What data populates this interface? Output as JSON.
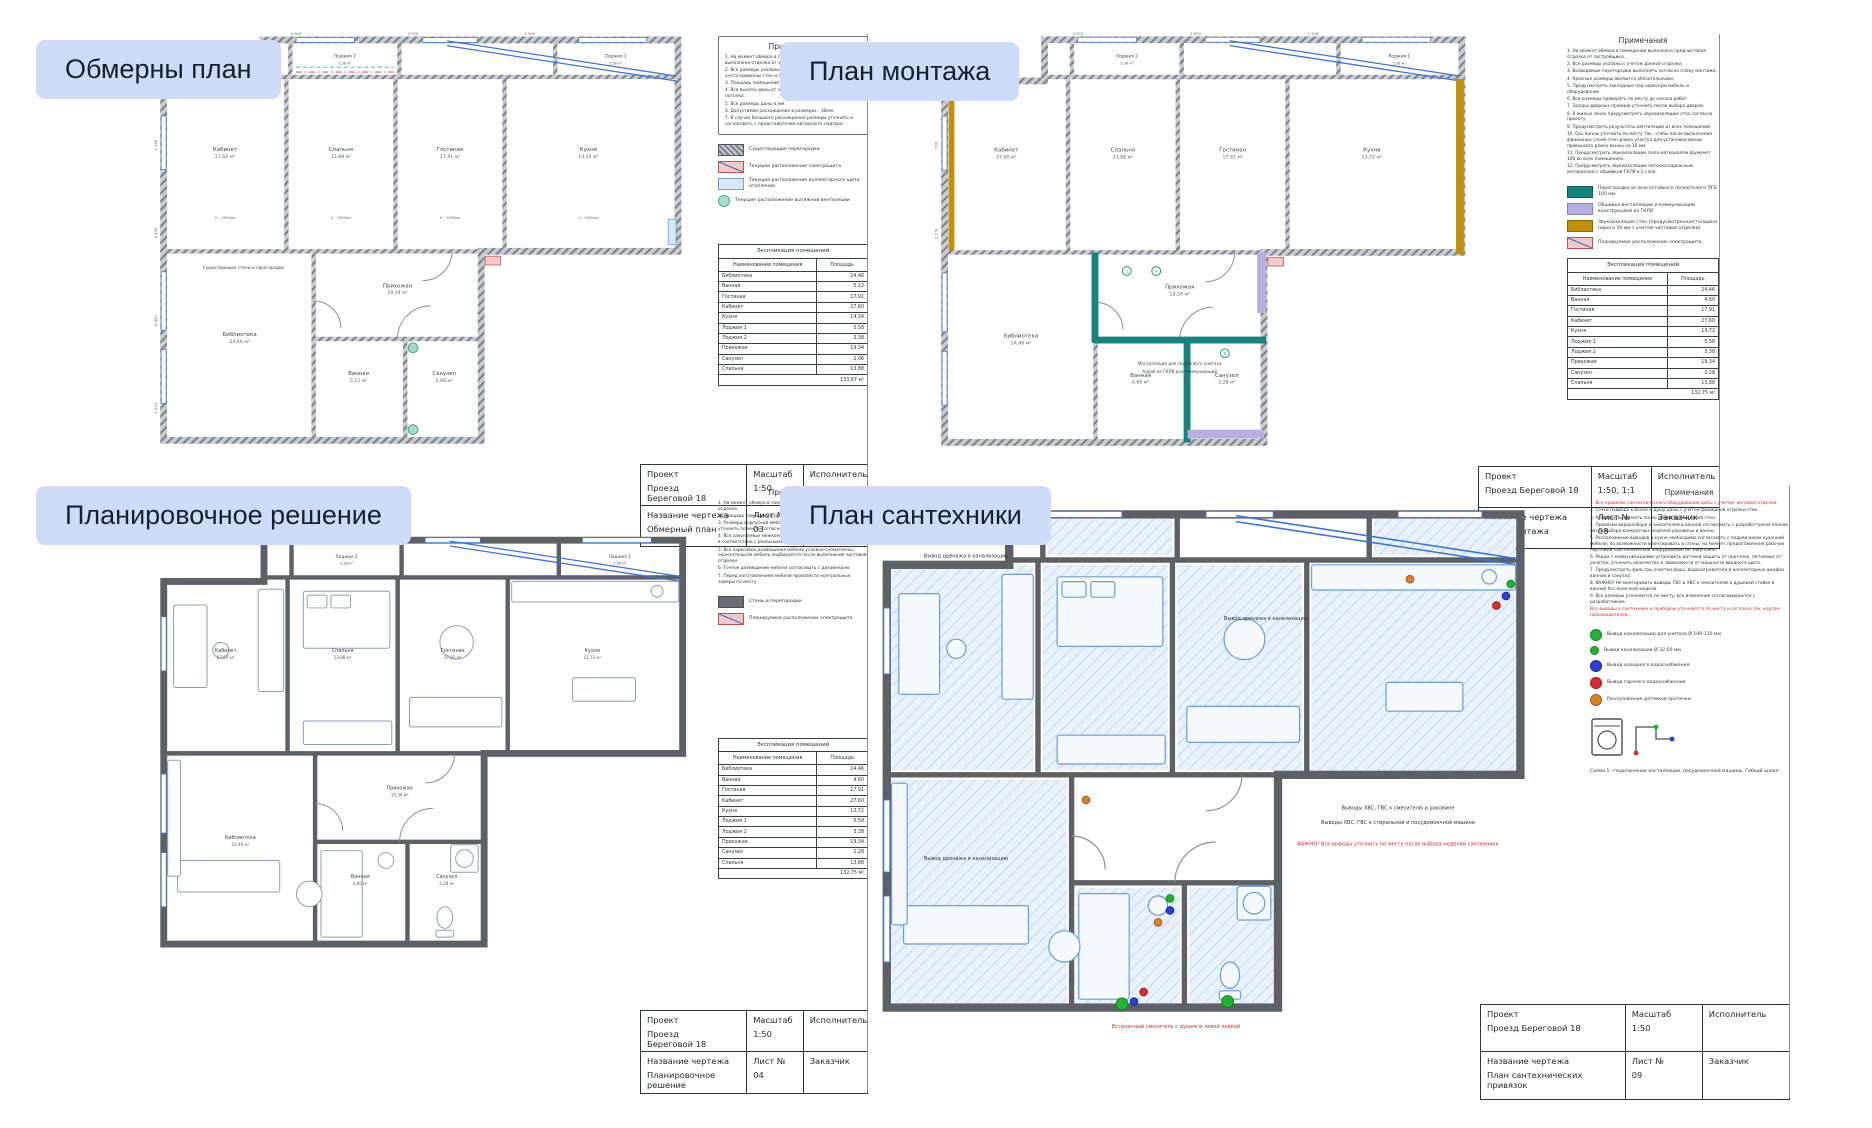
{
  "page": {
    "background": "#ffffff",
    "label_chip_color": "#cedbf7"
  },
  "sheets": [
    {
      "overlay_label": "Обмерны план",
      "notes": {
        "title": "Примечания",
        "boxed": true,
        "lines": [
          {
            "text": "1. На момент обмера в помещении предчистовая выполнена отделка от застройщика."
          },
          {
            "text": "2. Все размеры указаны с учетом данной отделки, без учета кривизны стен и перекрытий."
          },
          {
            "text": "3. Площадь помещений указаны без учета перегородок."
          },
          {
            "text": "4. Все высоты даны от чистового пола до существующего потолка."
          },
          {
            "text": "5. Все размеры даны в мм."
          },
          {
            "text": "6. Допустимое расхождение в размерах - 30мм."
          },
          {
            "text": "7. В случае большого расхождения размеры уточнить и согласовать с представителем авторского надзора."
          }
        ]
      },
      "legend": [
        {
          "kind": "hatch",
          "color": "#b9bdc4",
          "label": "Существующие перегородки"
        },
        {
          "kind": "ehatch",
          "color": "#f0caca",
          "border": "#c0504d",
          "label": "Текущее расположение электрощита"
        },
        {
          "kind": "solid",
          "color": "#d9e9fb",
          "border": "#6f9fd8",
          "label": "Текущее расположение коллекторного щита отопления"
        },
        {
          "kind": "circle",
          "color": "#a7ddd0",
          "border": "#55a391",
          "label": "Текущее расположение вытяжной вентиляции"
        }
      ],
      "table": {
        "title": "Экспликация помещений",
        "col1": "Наименование помещения",
        "col2": "Площадь",
        "rows": [
          [
            "Библиотека",
            "24,46"
          ],
          [
            "Ванная",
            "5,12"
          ],
          [
            "Гостиная",
            "17,91"
          ],
          [
            "Кабинет",
            "27,60"
          ],
          [
            "Кухня",
            "14,34"
          ],
          [
            "Лоджия 1",
            "5,58"
          ],
          [
            "Лоджия 2",
            "3,38"
          ],
          [
            "Прихожая",
            "19,34"
          ],
          [
            "Санузел",
            "2,06"
          ],
          [
            "Спальня",
            "13,88"
          ]
        ],
        "total": "133,67 м²"
      },
      "title_block": {
        "project_label": "Проект",
        "project": "Проезд\nБереговой 18",
        "scale_label": "Масштаб",
        "scale": "1:50",
        "executor_label": "Исполнитель",
        "drawing_label": "Название чертежа",
        "drawing": "Обмерный план",
        "sheet_label": "Лист №",
        "sheet": "03",
        "client_label": "Заказчик"
      },
      "plan": {
        "style": "measure",
        "rooms": [
          {
            "id": "kabinet",
            "name": "Кабинет",
            "area": "27,60 м²"
          },
          {
            "id": "spalnya",
            "name": "Спальня",
            "area": "13,88 м²"
          },
          {
            "id": "gostinaya",
            "name": "Гостиная",
            "area": "17,91 м²"
          },
          {
            "id": "kuhnya",
            "name": "Кухня",
            "area": "14,34 м²"
          },
          {
            "id": "lodzhiya2",
            "name": "Лоджия 2",
            "area": "3,38 м²"
          },
          {
            "id": "lodzhiya1",
            "name": "Лоджия 1",
            "area": "5,58 м²"
          },
          {
            "id": "prihozhaya",
            "name": "Прихожая",
            "area": "19,34 м²"
          },
          {
            "id": "biblioteka",
            "name": "Библиотека",
            "area": "24,46 м²"
          },
          {
            "id": "vannaya",
            "name": "Ванная",
            "area": "5,12 м²"
          },
          {
            "id": "sanuzel",
            "name": "Санузел",
            "area": "2,06 м²"
          }
        ],
        "dims": [
          "5 915",
          "2 970",
          "1 950",
          "1 226",
          "2 435",
          "6 450",
          "1 510"
        ],
        "height_note": "H - 2985мм",
        "annotations": [
          {
            "text": "Существующие стены и перегородки",
            "x": 96,
            "y": 247,
            "color": "#3a3f46"
          }
        ]
      }
    },
    {
      "overlay_label": "План монтажа",
      "notes": {
        "title": "Примечания",
        "boxed": false,
        "lines": [
          {
            "text": "1. На момент обмера в помещении выполнена предчистовая отделка от застройщика."
          },
          {
            "text": "2. Все размеры указаны с учетом данной отделки."
          },
          {
            "text": "3. Возводимые перегородки выполнять согласно плану монтажа."
          },
          {
            "text": "4. Красные размеры являются обязательными."
          },
          {
            "text": "5. Предусмотреть закладные под навесную мебель и оборудование."
          },
          {
            "text": "6. Все размеры проверять по месту до начала работ."
          },
          {
            "text": "7. Зазоры дверных проемов уточнить после выбора дверей."
          },
          {
            "text": "8. В жилых зонах предусмотреть звукоизоляцию стен согласно проекту."
          },
          {
            "text": "9. Предусмотреть результаты вентиляции из всех помещений."
          },
          {
            "text": "10. Ось ванны уточнить по месту так, чтобы после выполнения финишных слоев стен длина участка для установки ванны превышала длину ванны на 10 мм."
          },
          {
            "text": "11. Предусмотреть звукоизоляцию пола материалом Шуманет 100 во всех помещениях."
          },
          {
            "text": "12. Предусмотреть звукоизоляцию потолка каркасным материалом с обшивкой ГКЛВ в 2 слоя."
          }
        ]
      },
      "legend": [
        {
          "kind": "solid",
          "color": "#16837d",
          "border": "#0e5f5b",
          "label": "Перегородка из влагостойкого полнотелого ПГБ 100 мм"
        },
        {
          "kind": "solid",
          "color": "#b9aee4",
          "border": "#8b7fc4",
          "label": "Обшивка инсталляции и коммуникаций конструкцией из ГКЛВ"
        },
        {
          "kind": "solid",
          "color": "#c1900b",
          "border": "#8f6a06",
          "label": "Звукоизоляция стен (предусмотренная толщина пирога 50 мм с учетом чистовой отделки)"
        },
        {
          "kind": "ehatch",
          "color": "#f0caca",
          "border": "#c0504d",
          "label": "Планируемое расположение электрощита"
        }
      ],
      "table": {
        "title": "Экспликация помещений",
        "col1": "Наименование помещения",
        "col2": "Площадь",
        "rows": [
          [
            "Библиотека",
            "24,46"
          ],
          [
            "Ванная",
            "4,60"
          ],
          [
            "Гостиная",
            "17,91"
          ],
          [
            "Кабинет",
            "27,60"
          ],
          [
            "Кухня",
            "13,72"
          ],
          [
            "Лоджия 1",
            "5,58"
          ],
          [
            "Лоджия 2",
            "3,38"
          ],
          [
            "Прихожая",
            "19,34"
          ],
          [
            "Санузел",
            "2,28"
          ],
          [
            "Спальня",
            "13,88"
          ]
        ],
        "total": "132,75 м²"
      },
      "title_block": {
        "project_label": "Проект",
        "project": "Проезд Береговой 18",
        "scale_label": "Масштаб",
        "scale": "1:50, 1:1",
        "executor_label": "Исполнитель",
        "drawing_label": "Название чертежа",
        "drawing": "План монтажа",
        "sheet_label": "Лист №",
        "sheet": "08",
        "client_label": "Заказчик"
      },
      "plan": {
        "style": "montage",
        "rooms": [
          {
            "id": "kabinet",
            "name": "Кабинет",
            "area": "27,60 м²"
          },
          {
            "id": "spalnya",
            "name": "Спальня",
            "area": "13,88 м²"
          },
          {
            "id": "gostinaya",
            "name": "Гостиная",
            "area": "17,91 м²"
          },
          {
            "id": "kuhnya",
            "name": "Кухня",
            "area": "13,72 м²"
          },
          {
            "id": "lodzhiya2",
            "name": "Лоджия 2",
            "area": "3,38 м²"
          },
          {
            "id": "lodzhiya1",
            "name": "Лоджия 1",
            "area": "5,58 м²"
          },
          {
            "id": "prihozhaya",
            "name": "Прихожая",
            "area": "19,34 м²"
          },
          {
            "id": "biblioteka",
            "name": "Библиотека",
            "area": "24,46 м²"
          },
          {
            "id": "vannaya",
            "name": "Ванная",
            "area": "4,60 м²"
          },
          {
            "id": "sanuzel",
            "name": "Санузел",
            "area": "2,28 м²"
          }
        ],
        "dims": [
          "3 370",
          "2 970",
          "1 226",
          "700",
          "2 170"
        ],
        "annotations": [
          {
            "text": "Инсталляция для подвесного унитаза",
            "x": 254,
            "y": 344,
            "color": "#3a3f46"
          },
          {
            "text": "Короб из ГКЛВ для коммуникаций",
            "x": 254,
            "y": 352,
            "color": "#3a3f46"
          }
        ]
      }
    },
    {
      "overlay_label": "Планировочное решение",
      "notes": {
        "title": "Примечания",
        "boxed": false,
        "lines": [
          {
            "text": "1. На момент обмера в помещении выполнена предчистовая отделка."
          },
          {
            "text": "2. Площадь помещений указана без учета чистовой отделки."
          },
          {
            "text": "3. Размеры корпусной мебели и сантехнического оборудования уточнить по месту согласно спецификациям изделий."
          },
          {
            "text": "4. Все закупаемые межкомнатные конструкции корректировать в соответствии с реальными размерами после замеров."
          },
          {
            "text": "5. Все зарисовки размещения мебели условно-схематичны; окончательная мебель подбирается после выполнения чистовой отделки."
          },
          {
            "text": "6. Точное размещение мебели согласовать с дизайнером."
          },
          {
            "text": "7. Перед изготовлением мебели произвести контрольные замеры по месту."
          }
        ]
      },
      "legend": [
        {
          "kind": "solid",
          "color": "#6a6f76",
          "border": "#4a4e54",
          "label": "Стены и перегородки"
        },
        {
          "kind": "ehatch",
          "color": "#f0caca",
          "border": "#c0504d",
          "label": "Планируемое расположение электрощита"
        }
      ],
      "table": {
        "title": "Экспликация помещений",
        "col1": "Наименование помещения",
        "col2": "Площадь",
        "rows": [
          [
            "Библиотека",
            "24,46"
          ],
          [
            "Ванная",
            "4,60"
          ],
          [
            "Гостиная",
            "17,91"
          ],
          [
            "Кабинет",
            "27,60"
          ],
          [
            "Кухня",
            "13,72"
          ],
          [
            "Лоджия 1",
            "5,58"
          ],
          [
            "Лоджия 2",
            "3,38"
          ],
          [
            "Прихожая",
            "19,34"
          ],
          [
            "Санузел",
            "2,28"
          ],
          [
            "Спальня",
            "13,88"
          ]
        ],
        "total": "132,75 м²"
      },
      "title_block": {
        "project_label": "Проект",
        "project": "Проезд\nБереговой 18",
        "scale_label": "Масштаб",
        "scale": "1:50",
        "executor_label": "Исполнитель",
        "drawing_label": "Название чертежа",
        "drawing": "Планировочное\nрешение",
        "sheet_label": "Лист №",
        "sheet": "04",
        "client_label": "Заказчик"
      },
      "plan": {
        "style": "plan",
        "rooms": [
          {
            "id": "kabinet",
            "name": "Кабинет",
            "area": "27,60 м²"
          },
          {
            "id": "spalnya",
            "name": "Спальня",
            "area": "13,88 м²"
          },
          {
            "id": "gostinaya",
            "name": "Гостиная",
            "area": "17,91 м²"
          },
          {
            "id": "kuhnya",
            "name": "Кухня",
            "area": "13,72 м²"
          },
          {
            "id": "lodzhiya2",
            "name": "Лоджия 2",
            "area": "3,38 м²"
          },
          {
            "id": "lodzhiya1",
            "name": "Лоджия 1",
            "area": "5,58 м²"
          },
          {
            "id": "prihozhaya",
            "name": "Прихожая",
            "area": "19,34 м²"
          },
          {
            "id": "biblioteka",
            "name": "Библиотека",
            "area": "24,46 м²"
          },
          {
            "id": "vannaya",
            "name": "Ванная",
            "area": "4,60 м²"
          },
          {
            "id": "sanuzel",
            "name": "Санузел",
            "area": "2,28 м²"
          }
        ],
        "dims": [],
        "annotations": []
      }
    },
    {
      "overlay_label": "План сантехники",
      "notes": {
        "title": "Примечания",
        "boxed": false,
        "lines": [
          {
            "text": "1. Все привязки сантехнического оборудования даны с учетом чистовой отделки.",
            "color": "#d42a2a"
          },
          {
            "text": "2. Точки подвода к ванне и душу даны с учетом финишной отделки стен."
          },
          {
            "text": "3. Разводку выполнять после штукатурных слоев стен."
          },
          {
            "text": "4. Привязки водоразбора к смесителям в ванной согласовать с разработчиком планов после выбора конкретных моделей раковины и ванны."
          },
          {
            "text": "5. Расположение выводов в кухне необходимо согласовать с подрядчиком кухонной мебели; по возможности вмонтировать в стены; на момент предоставления рабочих чертежей сантехническое оборудование не закуплено."
          },
          {
            "text": "6. Рядом с коммуникациями установить датчики защиты от протечек, питаемые от розетки; уточнить количество в зависимости от мощности вводного щита."
          },
          {
            "text": "7. Предусмотреть фильтры очистки воды, водонагреватели в коллекторных шкафах ванной и санузла."
          },
          {
            "text": "8. ВАЖНО! Не монтировать выводы ГВС и ХВС к смесителям и душевой стойке в ванной без конечной модели."
          },
          {
            "text": "9. Все размеры уточняются по месту; все изменения согласовываются с разработчиком."
          },
          {
            "text": "Все выводы к сантехнике и приборам уточняются по месту и согласно тех. картам производителей.",
            "color": "#d42a2a"
          }
        ]
      },
      "legend": [
        {
          "kind": "circle",
          "color": "#24b232",
          "border": "#178223",
          "label": "Вывод канализации для унитаза Ø 100-110 мм"
        },
        {
          "kind": "circle",
          "color": "#24b232",
          "border": "#178223",
          "small": true,
          "label": "Вывод канализации Ø 32-50 мм"
        },
        {
          "kind": "circle",
          "color": "#2b3fd8",
          "border": "#1d2b9b",
          "label": "Вывод холодного водоснабжения"
        },
        {
          "kind": "circle",
          "color": "#d92b2b",
          "border": "#9e1d1d",
          "label": "Вывод горячего водоснабжения"
        },
        {
          "kind": "circle",
          "color": "#d9822b",
          "border": "#9e5c1d",
          "label": "Расположение датчиков протечки"
        }
      ],
      "table": null,
      "scheme_caption": "Схема 1 - подключение инсталляции, посудомоечной машины. Гибкий шланг.",
      "title_block": {
        "project_label": "Проект",
        "project": "Проезд Береговой 18",
        "scale_label": "Масштаб",
        "scale": "1:50",
        "executor_label": "Исполнитель",
        "drawing_label": "Название чертежа",
        "drawing": "План сантехнических\nпривязок",
        "sheet_label": "Лист №",
        "sheet": "09",
        "client_label": "Заказчик"
      },
      "plan": {
        "style": "plumbing",
        "rooms": [],
        "dims": [],
        "annotations": [
          {
            "text": "Вывод дренажа в канализацию",
            "x": 80,
            "y": 48,
            "color": "#2c3138"
          },
          {
            "text": "Вывод дренажа в канализацию",
            "x": 330,
            "y": 100,
            "color": "#2c3138"
          },
          {
            "text": "Вывод дренажа в канализацию",
            "x": 80,
            "y": 300,
            "color": "#2c3138"
          },
          {
            "text": "Выводы ХВС, ГВС к смесителю и раковине",
            "x": 440,
            "y": 258,
            "color": "#2c3138"
          },
          {
            "text": "Выводы ХВС, ГВС к стиральной и посудомоечной машине",
            "x": 440,
            "y": 270,
            "color": "#2c3138"
          },
          {
            "text": "ВАЖНО! Все выводы уточнить по месту после выбора моделей сантехники",
            "x": 440,
            "y": 288,
            "color": "#cf2b2b"
          },
          {
            "text": "Встроенный смеситель с душем и левой лейкой",
            "x": 255,
            "y": 440,
            "color": "#cf2b2b"
          }
        ]
      }
    }
  ]
}
